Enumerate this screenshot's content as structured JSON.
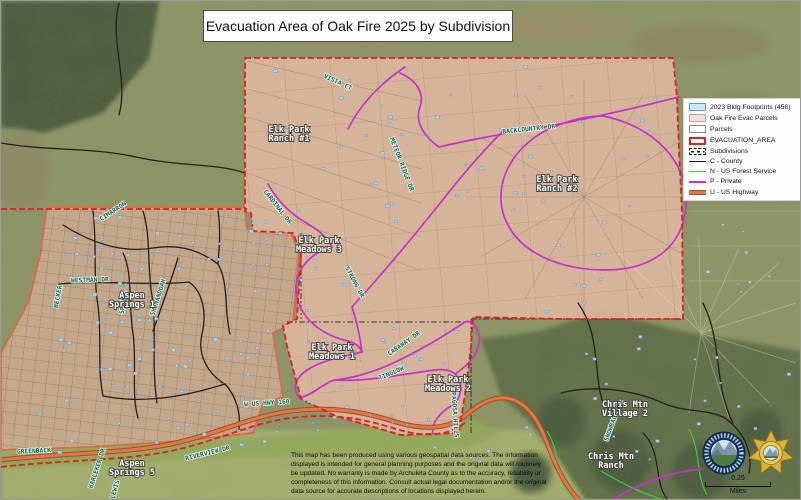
{
  "title": "Evacuation Area of Oak Fire 2025 by Subdivision",
  "legend": {
    "items": [
      "2023 Bldg Footprints  (456)",
      "Oak Fire Evac Parcels",
      "Parcels",
      "EVACUATION_AREA",
      "Subdivisions",
      "C - County",
      "N - US Forest Service",
      "P - Private",
      "U - US Highway"
    ]
  },
  "map": {
    "subdivisions": [
      {
        "l1": "Elk Park",
        "l2": "Ranch #1"
      },
      {
        "l1": "Elk Park",
        "l2": "Ranch #2"
      },
      {
        "l1": "Elk Park",
        "l2": "Meadows 3"
      },
      {
        "l1": "Elk Park",
        "l2": "Meadows 1"
      },
      {
        "l1": "Elk Park",
        "l2": "Meadows 2"
      },
      {
        "l1": "Aspen",
        "l2": "Springs 1"
      },
      {
        "l1": "Aspen",
        "l2": "Springs 5"
      },
      {
        "l1": "Chris Mtn",
        "l2": "Village 2"
      },
      {
        "l1": "Chris Mtn",
        "l2": "Ranch"
      }
    ],
    "roads": [
      "GREENBACK",
      "W US HWY 160",
      "WESTMAN DR",
      "SHENANDOAH",
      "SPRUCE",
      "BECKER",
      "CIMARRON",
      "CARDINAL DR",
      "VISTA CT",
      "BACKCOUNTRY DR",
      "METEOR RIDGE DR",
      "STRONG DR",
      "CARAWAY DR",
      "TINGLOW",
      "PAGOSA HILLS",
      "RIVERVIEW DR",
      "HARLEKER DR",
      "LEWIS",
      "SNOWBALL RD"
    ]
  },
  "scale": {
    "distance": "0.25",
    "units": "Miles"
  },
  "disclaimer": "This map has been produced using various geospatial data sources.  The information displayed is intended for general planning purposes and the original data will routinely be updated.  No warranty is made by Archuleta County as to the accuracy, reliability or completeness of this information.  Consult actual legal documentation and/or the original data source for accurate descriptions of locations displayed herein.",
  "icons": {
    "county_seal": "archuleta-county-seal",
    "sheriff_badge": "sheriff-star-badge"
  },
  "colors": {
    "evacuation_red": "#dd2020",
    "evac_parcel_pink": "#dbb69e",
    "bldg_footprint_blue": "#a9d2ee",
    "private_road_magenta": "#c433c9",
    "county_road_black": "#24201a",
    "forest_service_green": "#35d435",
    "us_highway_orange": "#e0784a",
    "road_label_teal": "#0d6b5e"
  }
}
